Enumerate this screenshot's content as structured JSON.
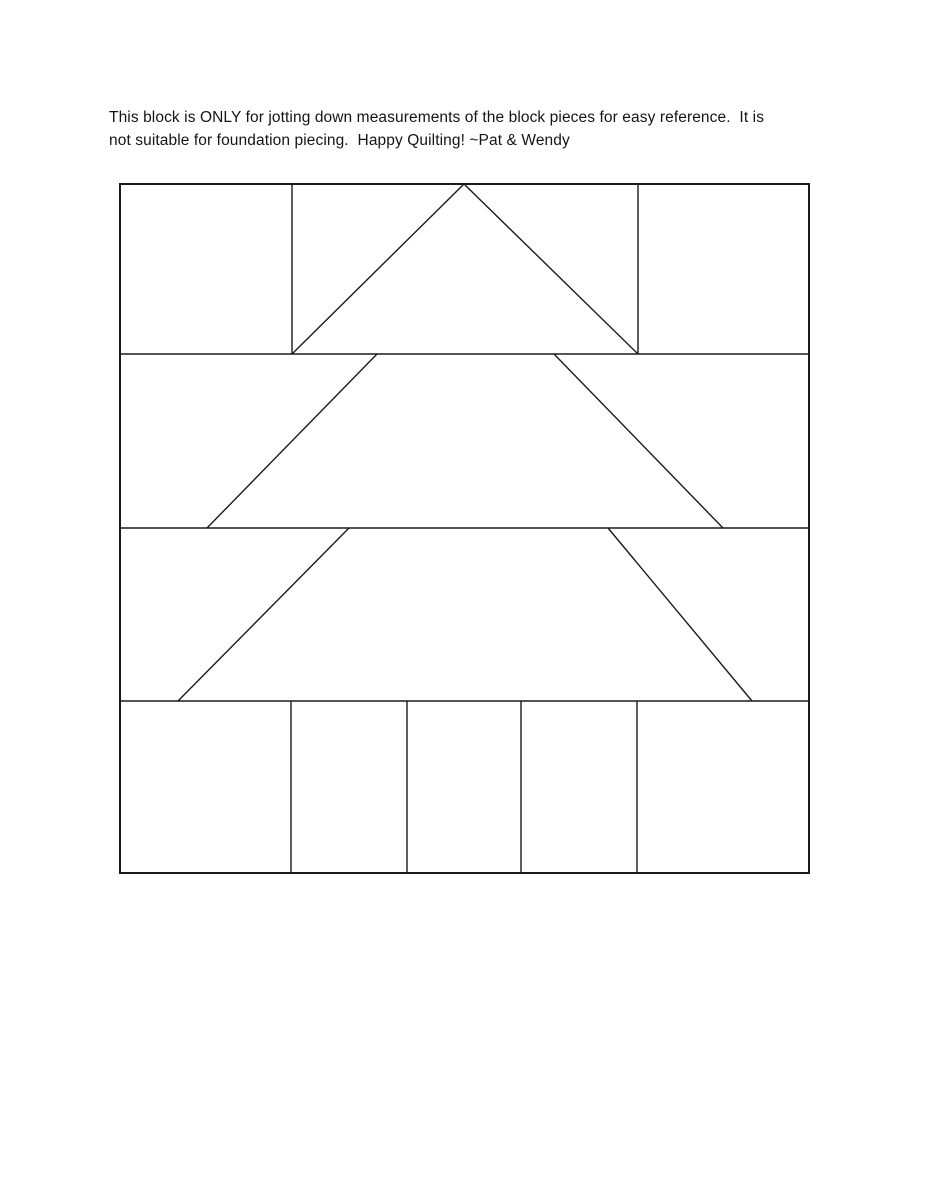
{
  "note": {
    "line1": "This block is ONLY for jotting down measurements of the block pieces for easy reference.  It is",
    "line2": "not suitable for foundation piecing.  Happy Quilting! ~Pat & Wendy"
  },
  "diagram": {
    "title": "tree-quilt-block-measurement-diagram",
    "background": "#ffffff",
    "stroke_color": "#1b1b1b",
    "border_stroke_width": 2,
    "line_stroke_width": 1.4,
    "size": 691,
    "border": {
      "name": "block-outline",
      "x": 1,
      "y": 1,
      "width": 689,
      "height": 689
    },
    "lines": [
      {
        "name": "row-divider-1",
        "x1": 0,
        "y1": 171,
        "x2": 691,
        "y2": 171
      },
      {
        "name": "row-divider-2",
        "x1": 0,
        "y1": 345,
        "x2": 691,
        "y2": 345
      },
      {
        "name": "row-divider-3",
        "x1": 0,
        "y1": 518,
        "x2": 691,
        "y2": 518
      },
      {
        "name": "row1-left-seam",
        "x1": 173,
        "y1": 0,
        "x2": 173,
        "y2": 171
      },
      {
        "name": "row1-right-seam",
        "x1": 519,
        "y1": 0,
        "x2": 519,
        "y2": 171
      },
      {
        "name": "tree-top-left-edge",
        "x1": 173,
        "y1": 171,
        "x2": 345,
        "y2": 1
      },
      {
        "name": "tree-top-right-edge",
        "x1": 345,
        "y1": 1,
        "x2": 519,
        "y2": 171
      },
      {
        "name": "tree-middle-left-edge",
        "x1": 258,
        "y1": 171,
        "x2": 88,
        "y2": 345
      },
      {
        "name": "tree-middle-right-edge",
        "x1": 435,
        "y1": 171,
        "x2": 604,
        "y2": 345
      },
      {
        "name": "tree-lower-left-edge",
        "x1": 230,
        "y1": 345,
        "x2": 59,
        "y2": 518
      },
      {
        "name": "tree-lower-right-edge",
        "x1": 489,
        "y1": 345,
        "x2": 633,
        "y2": 518
      },
      {
        "name": "trunk-row-seam-1",
        "x1": 172,
        "y1": 518,
        "x2": 172,
        "y2": 691
      },
      {
        "name": "trunk-row-seam-2",
        "x1": 288,
        "y1": 518,
        "x2": 288,
        "y2": 691
      },
      {
        "name": "trunk-row-seam-3",
        "x1": 402,
        "y1": 518,
        "x2": 402,
        "y2": 691
      },
      {
        "name": "trunk-row-seam-4",
        "x1": 518,
        "y1": 518,
        "x2": 518,
        "y2": 691
      }
    ]
  }
}
